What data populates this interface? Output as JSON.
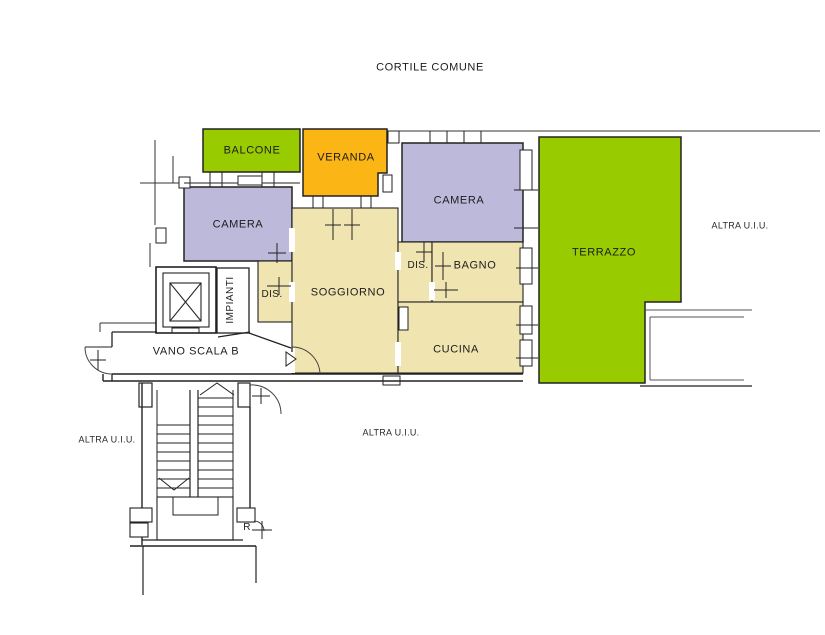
{
  "colors": {
    "green": "#99CC00",
    "orange": "#FBB515",
    "lilac": "#BDB9DB",
    "beige": "#F0E4B0",
    "wall": "#222222"
  },
  "labels": {
    "courtyard": "CORTILE COMUNE",
    "balcony": "BALCONE",
    "veranda": "VERANDA",
    "bedroom1": "CAMERA",
    "bedroom2": "CAMERA",
    "terrace": "TERRAZZO",
    "hall1": "DIS.",
    "living": "SOGGIORNO",
    "hall2": "DIS.",
    "bathroom": "BAGNO",
    "kitchen": "CUCINA",
    "utilities": "IMPIANTI",
    "stairwell": "VANO SCALA B",
    "storage": "R",
    "other_unit_left": "ALTRA U.I.U.",
    "other_unit_center": "ALTRA U.I.U.",
    "other_unit_right": "ALTRA U.I.U."
  }
}
